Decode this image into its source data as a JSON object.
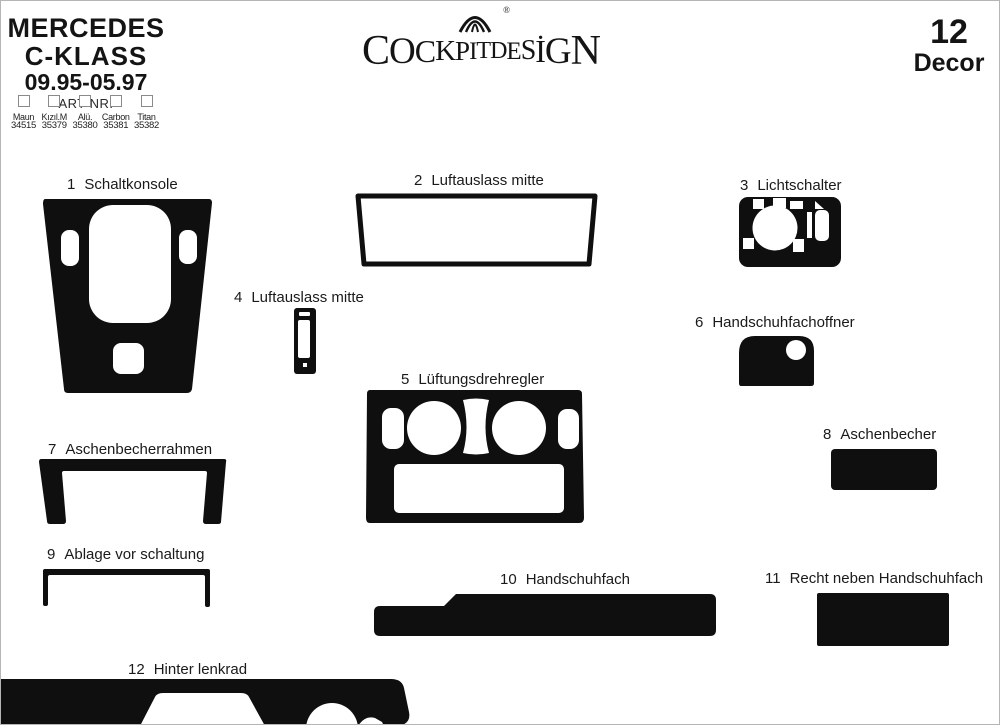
{
  "header": {
    "brand": {
      "line1": "MERCEDES",
      "line2": "C-KLASS",
      "line3": "09.95-05.97",
      "art_nr_label": "ART NR:"
    },
    "finishes": [
      {
        "name": "Maun",
        "number": "34515"
      },
      {
        "name": "Kızıl.M",
        "number": "35379"
      },
      {
        "name": "Alü.",
        "number": "35380"
      },
      {
        "name": "Carbon",
        "number": "35381"
      },
      {
        "name": "Titan",
        "number": "35382"
      }
    ],
    "logo": {
      "text": "COCKPITDESİGN",
      "letters": [
        "C",
        "O",
        "C",
        "K",
        "P",
        "I",
        "T",
        "D",
        "E",
        "S",
        "İ",
        "G",
        "N"
      ],
      "registered": "®",
      "emblem_icon": "fan-shell-emblem"
    },
    "decor": {
      "count": "12",
      "label": "Decor"
    }
  },
  "parts": [
    {
      "num": "1",
      "name": "Schaltkonsole"
    },
    {
      "num": "2",
      "name": "Luftauslass mitte"
    },
    {
      "num": "3",
      "name": "Lichtschalter"
    },
    {
      "num": "4",
      "name": "Luftauslass mitte"
    },
    {
      "num": "5",
      "name": "Lüftungsdrehregler"
    },
    {
      "num": "6",
      "name": "Handschuhfachoffner"
    },
    {
      "num": "7",
      "name": "Aschenbecherrahmen"
    },
    {
      "num": "8",
      "name": "Aschenbecher"
    },
    {
      "num": "9",
      "name": "Ablage vor schaltung"
    },
    {
      "num": "10",
      "name": "Handschuhfach"
    },
    {
      "num": "11",
      "name": "Recht neben Handschuhfach"
    },
    {
      "num": "12",
      "name": "Hinter lenkrad"
    }
  ],
  "colors": {
    "ink": "#0f0f0f",
    "paper": "#ffffff",
    "page_border": "#b5b5b5",
    "checkbox_border": "#8a8a8a"
  }
}
